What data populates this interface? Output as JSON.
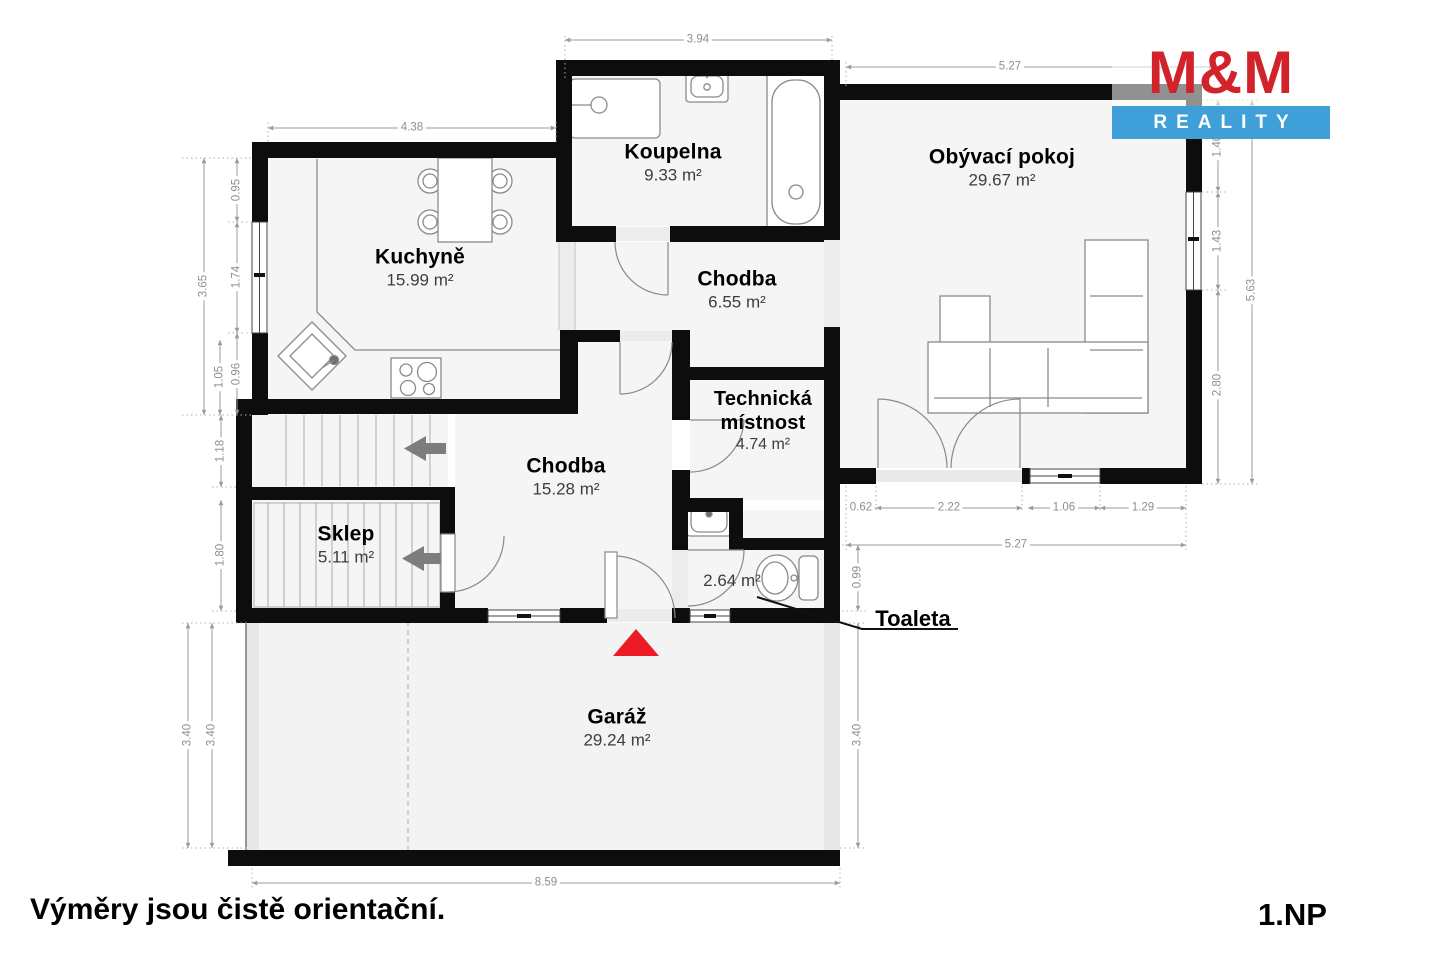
{
  "logo": {
    "top": "M&M",
    "bottom": "REALITY",
    "red": "#d2232a",
    "blue": "#3f9fd8"
  },
  "rooms": {
    "koupelna": {
      "name": "Koupelna",
      "area": "9.33 m²"
    },
    "obyvaci": {
      "name": "Obývací pokoj",
      "area": "29.67 m²"
    },
    "kuchyne": {
      "name": "Kuchyně",
      "area": "15.99 m²"
    },
    "chodba_horni": {
      "name": "Chodba",
      "area": "6.55 m²"
    },
    "technicka": {
      "name": "Technická místnost",
      "line1": "Technická",
      "line2": "místnost",
      "area": "4.74 m²"
    },
    "chodba_dolni": {
      "name": "Chodba",
      "area": "15.28 m²"
    },
    "sklep": {
      "name": "Sklep",
      "area": "5.11 m²"
    },
    "toaleta": {
      "name": "Toaleta",
      "area": "2.64 m²"
    },
    "garaz": {
      "name": "Garáž",
      "area": "29.24 m²"
    }
  },
  "dims": {
    "bath_top": "3.94",
    "living_top": "5.27",
    "kitchen_top": "4.38",
    "left_095": "0.95",
    "left_174": "1.74",
    "left_096": "0.96",
    "left_365": "3.65",
    "left_105": "1.05",
    "left_118": "1.18",
    "left_180": "1.80",
    "garage_left_outer": "3.40",
    "garage_left_inner": "3.40",
    "garage_right": "3.40",
    "garage_bottom": "8.59",
    "right_140": "1.40",
    "right_143": "1.43",
    "right_280": "2.80",
    "right_563": "5.63",
    "lv_062": "0.62",
    "lv_222": "2.22",
    "lv_106": "1.06",
    "lv_129": "1.29",
    "lv_527": "5.27",
    "toilet_099": "0.99"
  },
  "footer": {
    "disclaimer": "Výměry jsou čistě orientační.",
    "floor": "1.NP"
  },
  "colors": {
    "wall": "#0d0d0d",
    "entrance_red": "#ed1c24",
    "dim_gray": "#9b9b9b"
  }
}
